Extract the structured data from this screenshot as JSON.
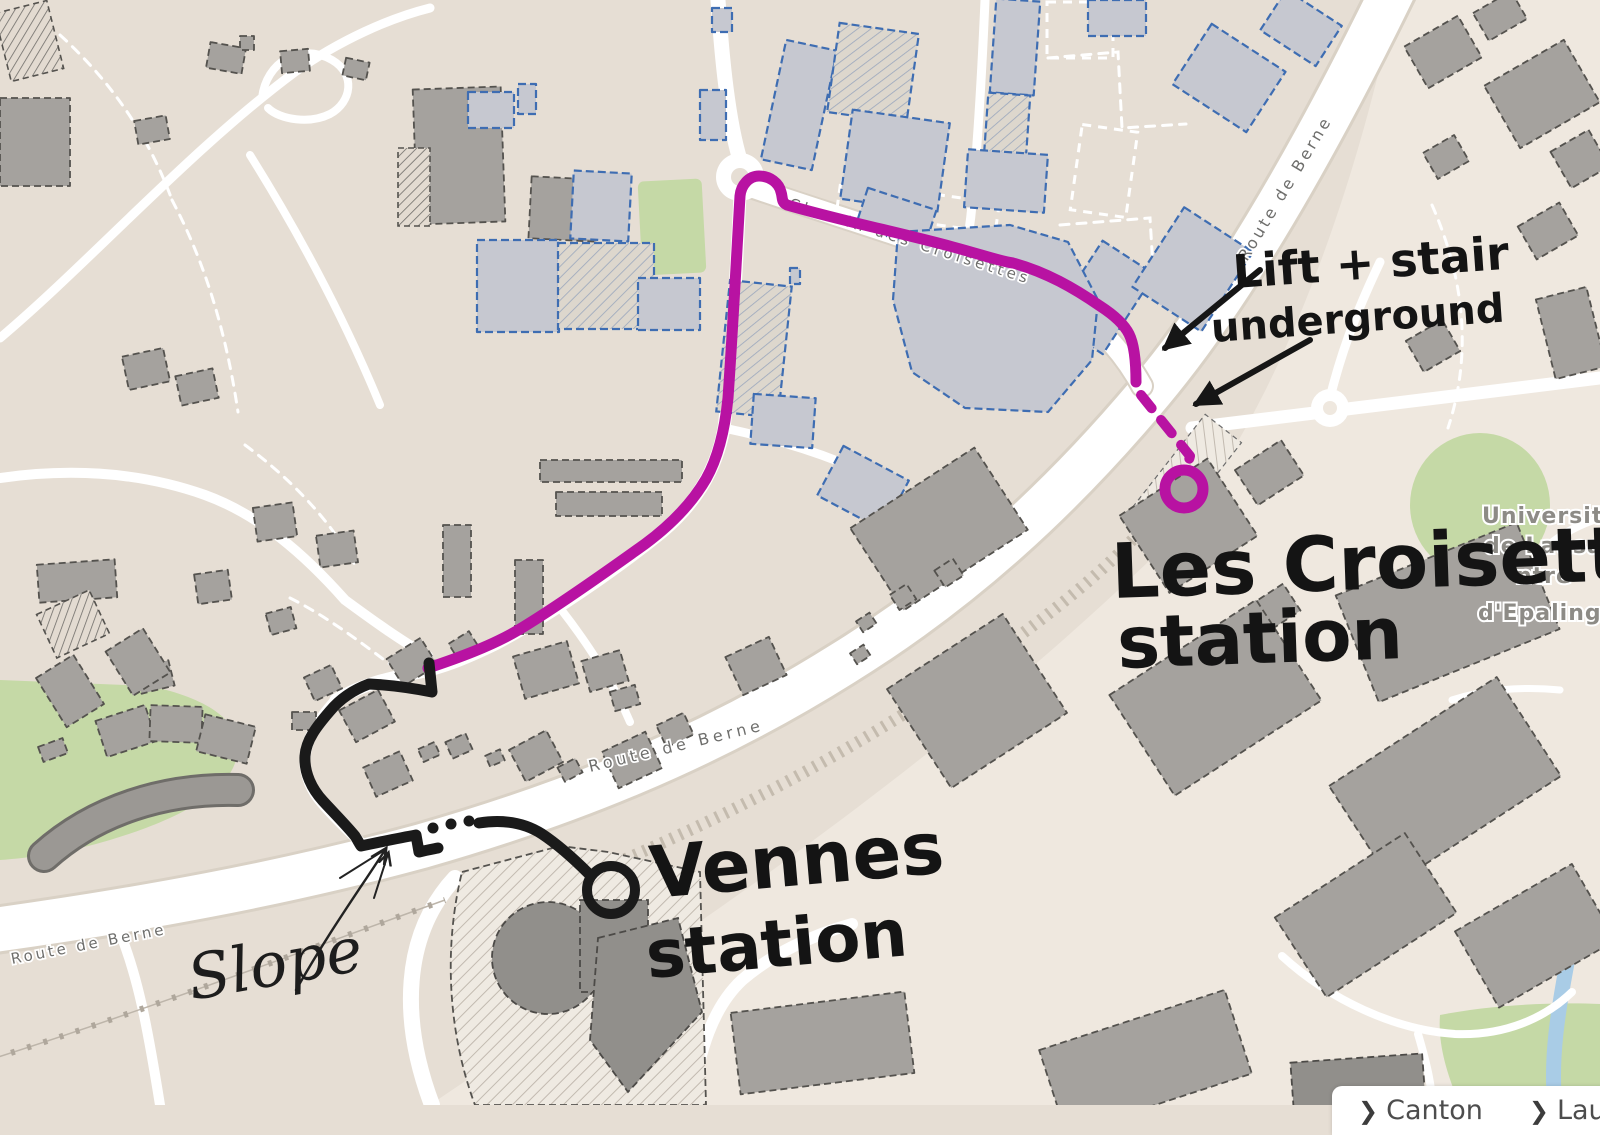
{
  "map": {
    "street_labels": {
      "croisettes": "Chemin des Croisettes",
      "berne_top": "Route de Berne",
      "berne_mid": "Route de Berne",
      "berne_bottom": "Route de Berne"
    },
    "place_labels": {
      "university_line1": "Universit",
      "university_line2": "de Lausa",
      "university_line3": "ntre",
      "university_line4": "d'Epaling"
    }
  },
  "annotations": {
    "lift_line1": "Lift + stair",
    "lift_line2": "underground",
    "croisettes_line1": "Les Croisettes",
    "croisettes_line2": "station",
    "vennes_line1": "Vennes",
    "vennes_line2": "station",
    "slope": "Slope"
  },
  "breadcrumb": {
    "chevron": "❯",
    "items": [
      {
        "label": "Canton"
      },
      {
        "label": "Lausanne"
      }
    ]
  },
  "colors": {
    "route_highlight": "#b812a2",
    "route_walk": "#1a1a1a",
    "map_background": "#e6ded4",
    "map_background_light": "#efe8df",
    "building_fill": "#a5a29e",
    "commercial_outline": "#3e6db2",
    "green_area": "#c5d9a6",
    "water": "#a9cce6",
    "road": "#ffffff"
  }
}
